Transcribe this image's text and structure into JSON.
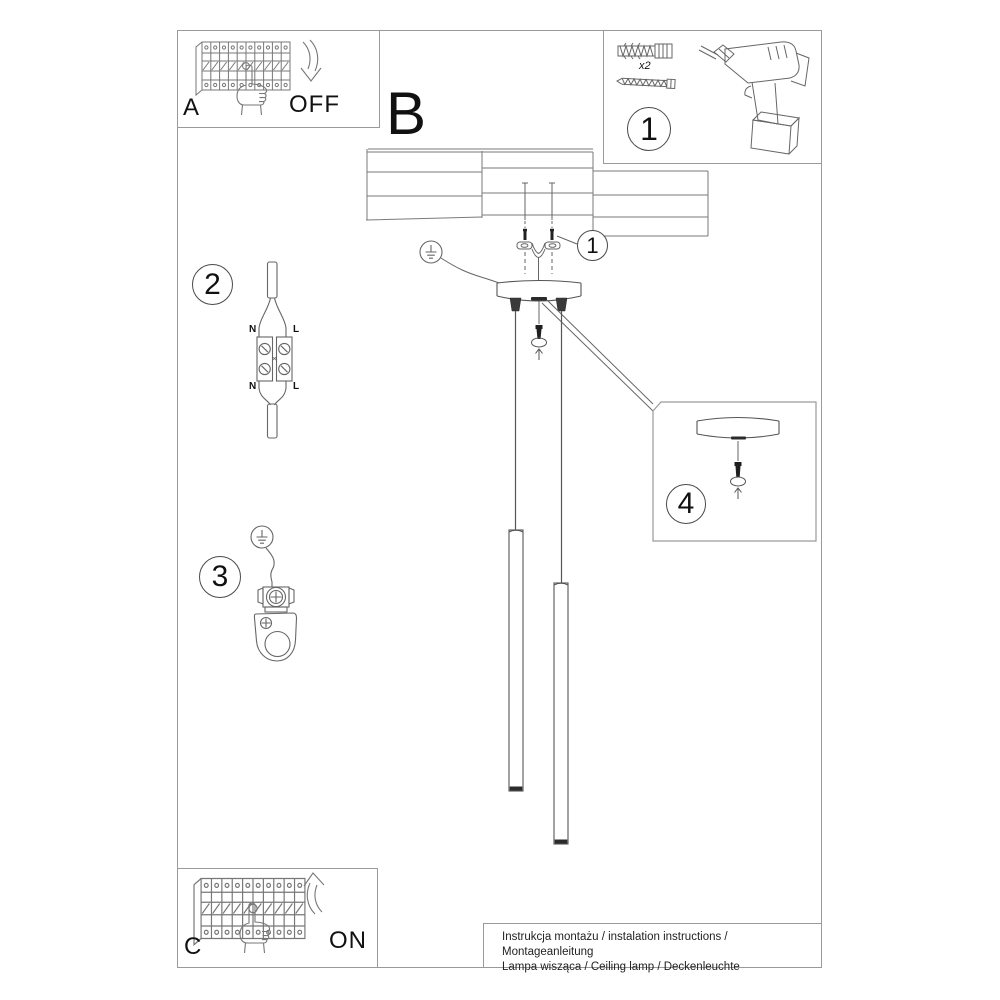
{
  "colors": {
    "line": "#666666",
    "dark_fill": "#2b2b2b",
    "box_border": "#9a9a9a"
  },
  "panel_a": {
    "label": "A",
    "action": "OFF"
  },
  "panel_c": {
    "label": "C",
    "action": "ON"
  },
  "section_b": {
    "label": "B"
  },
  "tools_box": {
    "badge": "1",
    "anchor_qty": "x2"
  },
  "callouts": {
    "bracket_screws": "1",
    "step2": "2",
    "step3": "3",
    "step4": "4"
  },
  "wiring": {
    "n_top": "N",
    "l_top": "L",
    "n_bottom": "N",
    "l_bottom": "L"
  },
  "footer": {
    "line1": "Instrukcja montażu / instalation instructions / Montageanleitung",
    "line2": "Lampa wisząca / Ceiling lamp / Deckenleuchte"
  }
}
